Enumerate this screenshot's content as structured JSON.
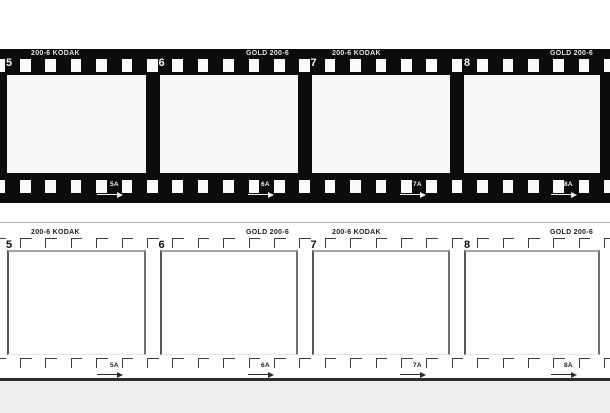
{
  "graphic": {
    "subject": "35mm film strips, negative (black) and outline (white) versions",
    "edge_texts": [
      "200-6 KODAK",
      "GOLD 200-6",
      "200-6 KODAK",
      "GOLD 200-6"
    ],
    "frame_numbers": [
      "5",
      "6",
      "7",
      "8"
    ],
    "half_frame_labels": [
      "5A",
      "6A",
      "7A",
      "8A"
    ],
    "strips": [
      {
        "name": "negative-film-strip",
        "variant": "dark"
      },
      {
        "name": "outline-film-strip",
        "variant": "light"
      }
    ]
  },
  "colors": {
    "film_black": "#0c0c0c",
    "sprocket_white": "#fafafa",
    "frame_white": "#f8f8f8",
    "outline_ink": "#3d3d3d",
    "frame_border_top": "#a2a2a2",
    "frame_border_side": "#585858",
    "strip_top_hairline": "#b5b5b5",
    "strip_bottom_rule": "#2d2d2d",
    "page_background": "#fdfdfd",
    "footer_background": "#eeeeee"
  }
}
